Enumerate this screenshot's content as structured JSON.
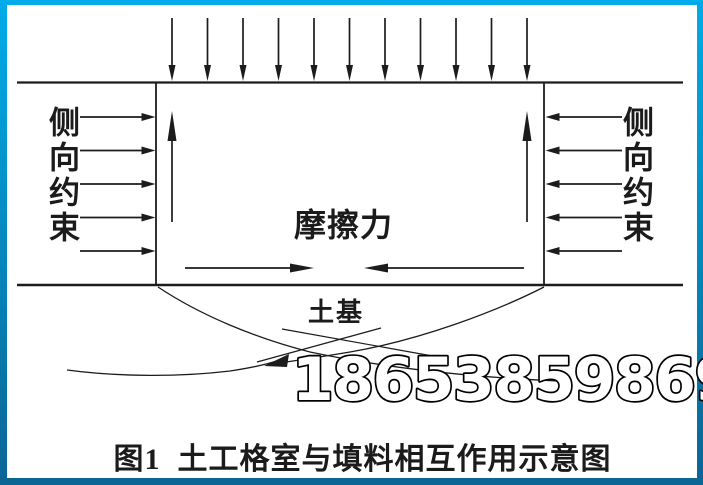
{
  "figure": {
    "caption": "图1  土工格室与填料相互作用示意图",
    "watermark": "18653859869",
    "labels": {
      "left_constraint": "侧向约束",
      "right_constraint": "侧向约束",
      "friction": "摩擦力",
      "subgrade": "土基"
    },
    "arrow_counts": {
      "top_load": 11,
      "left_confinement": 5,
      "right_confinement": 5,
      "internal_uplift": 2,
      "bottom_friction": 2
    },
    "colors": {
      "frame_top": "#00ace9",
      "frame_bottom": "#0b6595",
      "ink": "#1c1c1c",
      "background": "#ffffff",
      "watermark_fill": "#ffffff",
      "watermark_outline": "#000000"
    }
  }
}
